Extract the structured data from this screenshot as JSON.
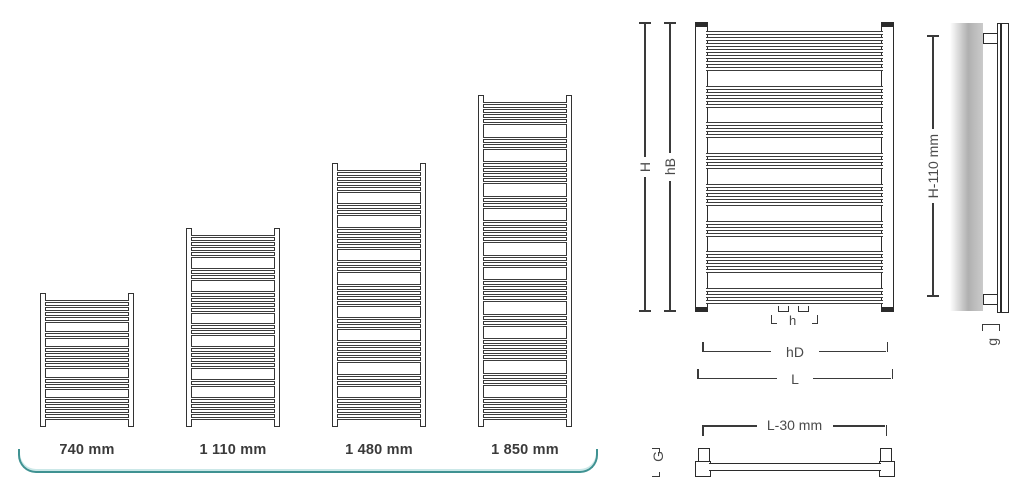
{
  "figure": {
    "size_variants": [
      {
        "label": "740 mm",
        "height_px": 134,
        "width_px": 94,
        "tube_groups": [
          5,
          2,
          5,
          3,
          5
        ]
      },
      {
        "label": "1 110 mm",
        "height_px": 199,
        "width_px": 94,
        "tube_groups": [
          5,
          3,
          5,
          3,
          5,
          2,
          5
        ]
      },
      {
        "label": "1 480 mm",
        "height_px": 264,
        "width_px": 94,
        "tube_groups": [
          5,
          3,
          5,
          3,
          5,
          3,
          5,
          3,
          5
        ]
      },
      {
        "label": "1 850 mm",
        "height_px": 332,
        "width_px": 94,
        "tube_groups": [
          5,
          3,
          5,
          3,
          5,
          3,
          5,
          3,
          5,
          3,
          5
        ]
      }
    ],
    "front_view": {
      "tube_groups": [
        7,
        4,
        3,
        3,
        4,
        3,
        4,
        3
      ],
      "labels": {
        "overall_height": "H",
        "tube_section_height": "hB",
        "connection_spacing": "h",
        "connection_width": "hD",
        "overall_width": "L"
      }
    },
    "side_view": {
      "labels": {
        "mounting_height": "H-110 mm",
        "wall_clearance": "g"
      }
    },
    "top_view": {
      "labels": {
        "tube_length": "L-30 mm",
        "depth": "G"
      }
    },
    "colors": {
      "accent": "#3f9292",
      "line": "#2b2b2b",
      "label_text": "#4a4a4a"
    }
  }
}
